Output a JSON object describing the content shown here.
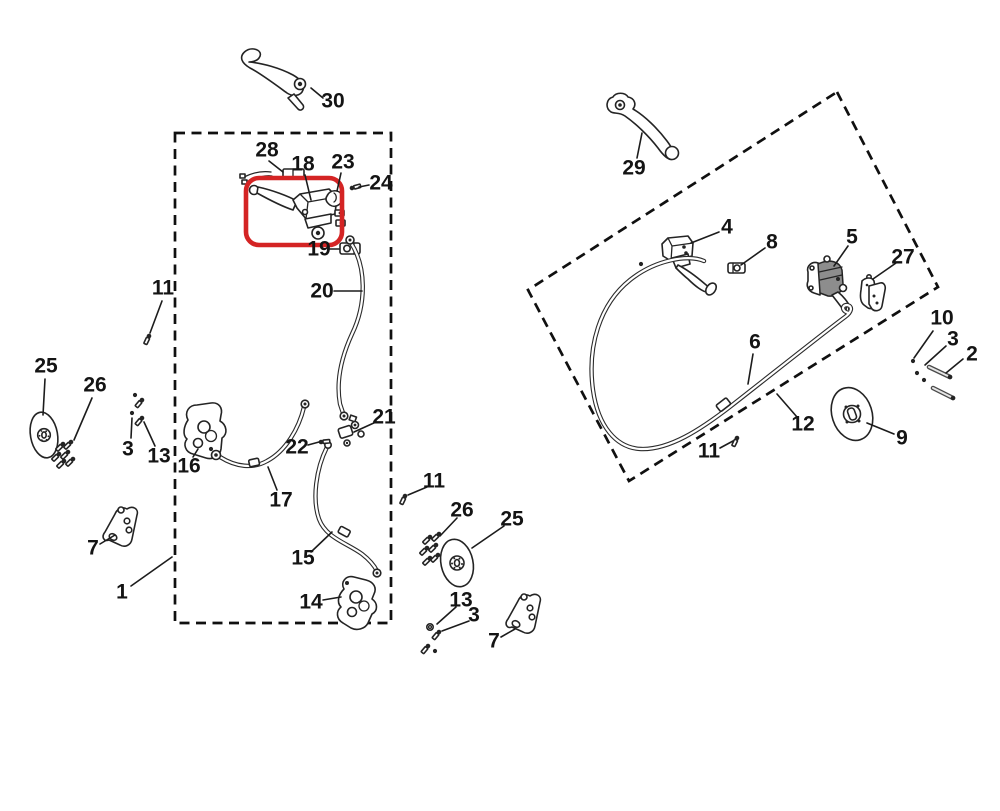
{
  "canvas": {
    "width": 1000,
    "height": 811,
    "background": "#ffffff"
  },
  "colors": {
    "line": "#242424",
    "highlight_red": "#d42424"
  },
  "highlight_box": {
    "x": 246,
    "y": 178,
    "width": 96,
    "height": 67,
    "rx": 13,
    "highlights_part": "18"
  },
  "group_boxes": {
    "front": {
      "type": "rect",
      "x": 175,
      "y": 133,
      "width": 216,
      "height": 490
    },
    "rear": {
      "type": "polygon",
      "points": "837,92 938,287 629,481 528,290"
    }
  },
  "callouts": [
    {
      "n": "30",
      "x": 333,
      "y": 101,
      "l": [
        311,
        88,
        323,
        98
      ]
    },
    {
      "n": "29",
      "x": 634,
      "y": 168,
      "l": [
        642,
        133,
        637,
        158
      ]
    },
    {
      "n": "28",
      "x": 267,
      "y": 150,
      "l": [
        269,
        161,
        283,
        172
      ]
    },
    {
      "n": "18",
      "x": 303,
      "y": 164,
      "l": [
        305,
        175,
        311,
        200
      ]
    },
    {
      "n": "23",
      "x": 343,
      "y": 162,
      "l": [
        341,
        173,
        337,
        191
      ]
    },
    {
      "n": "24",
      "x": 381,
      "y": 183,
      "l": [
        369,
        185,
        359,
        187
      ]
    },
    {
      "n": "19",
      "x": 319,
      "y": 249,
      "l": [
        330,
        249,
        339,
        249
      ]
    },
    {
      "n": "20",
      "x": 322,
      "y": 291,
      "l": [
        334,
        291,
        362,
        291
      ]
    },
    {
      "n": "11",
      "x": 163,
      "y": 288,
      "l": [
        162,
        301,
        150,
        333
      ]
    },
    {
      "n": "25",
      "x": 46,
      "y": 366,
      "l": [
        45,
        379,
        43,
        415
      ]
    },
    {
      "n": "26",
      "x": 95,
      "y": 385,
      "l": [
        92,
        398,
        74,
        440
      ]
    },
    {
      "n": "3",
      "x": 128,
      "y": 449,
      "l": [
        131,
        438,
        132,
        418
      ]
    },
    {
      "n": "13",
      "x": 159,
      "y": 456,
      "l": [
        155,
        446,
        144,
        422
      ]
    },
    {
      "n": "16",
      "x": 189,
      "y": 466,
      "l": [
        193,
        457,
        198,
        449
      ]
    },
    {
      "n": "17",
      "x": 281,
      "y": 500,
      "l": [
        277,
        490,
        268,
        467
      ]
    },
    {
      "n": "22",
      "x": 297,
      "y": 447,
      "l": [
        308,
        445,
        319,
        442
      ]
    },
    {
      "n": "21",
      "x": 384,
      "y": 417,
      "l": [
        376,
        422,
        354,
        432
      ]
    },
    {
      "n": "15",
      "x": 303,
      "y": 558,
      "l": [
        311,
        552,
        332,
        532
      ]
    },
    {
      "n": "14",
      "x": 311,
      "y": 602,
      "l": [
        323,
        600,
        341,
        597
      ]
    },
    {
      "n": "7",
      "x": 93,
      "y": 548,
      "l": [
        100,
        544,
        115,
        535
      ]
    },
    {
      "n": "1",
      "x": 122,
      "y": 592,
      "l": [
        131,
        586,
        172,
        557
      ]
    },
    {
      "n": "11",
      "x": 434,
      "y": 481,
      "l": [
        427,
        487,
        408,
        495
      ]
    },
    {
      "n": "26",
      "x": 462,
      "y": 510,
      "l": [
        457,
        518,
        440,
        536
      ]
    },
    {
      "n": "25",
      "x": 512,
      "y": 519,
      "l": [
        504,
        526,
        472,
        548
      ]
    },
    {
      "n": "13",
      "x": 461,
      "y": 600,
      "l": [
        456,
        607,
        437,
        624
      ]
    },
    {
      "n": "3",
      "x": 474,
      "y": 615,
      "l": [
        469,
        621,
        442,
        631
      ]
    },
    {
      "n": "7",
      "x": 494,
      "y": 641,
      "l": [
        501,
        637,
        515,
        629
      ]
    },
    {
      "n": "4",
      "x": 727,
      "y": 227,
      "l": [
        719,
        232,
        691,
        243
      ]
    },
    {
      "n": "8",
      "x": 772,
      "y": 242,
      "l": [
        765,
        248,
        741,
        265
      ]
    },
    {
      "n": "5",
      "x": 852,
      "y": 237,
      "l": [
        848,
        246,
        834,
        266
      ]
    },
    {
      "n": "27",
      "x": 903,
      "y": 257,
      "l": [
        896,
        263,
        873,
        279
      ]
    },
    {
      "n": "6",
      "x": 755,
      "y": 342,
      "l": [
        753,
        354,
        748,
        384
      ]
    },
    {
      "n": "12",
      "x": 803,
      "y": 424,
      "l": [
        797,
        417,
        777,
        394
      ]
    },
    {
      "n": "11",
      "x": 709,
      "y": 451,
      "l": [
        720,
        448,
        733,
        441
      ]
    },
    {
      "n": "10",
      "x": 942,
      "y": 318,
      "l": [
        933,
        331,
        914,
        358
      ]
    },
    {
      "n": "3",
      "x": 953,
      "y": 339,
      "l": [
        946,
        346,
        925,
        365
      ]
    },
    {
      "n": "2",
      "x": 972,
      "y": 354,
      "l": [
        963,
        359,
        946,
        373
      ]
    },
    {
      "n": "9",
      "x": 902,
      "y": 438,
      "l": [
        894,
        434,
        867,
        423
      ]
    }
  ],
  "hardware": {
    "bolts": [
      [
        352,
        188,
        -15
      ],
      [
        321,
        442,
        -5
      ],
      [
        149,
        336,
        115
      ],
      [
        142,
        400,
        130
      ],
      [
        142,
        418,
        130
      ],
      [
        63,
        444,
        135
      ],
      [
        71,
        442,
        135
      ],
      [
        59,
        454,
        135
      ],
      [
        68,
        452,
        135
      ],
      [
        64,
        461,
        135
      ],
      [
        73,
        459,
        135
      ],
      [
        405,
        496,
        115
      ],
      [
        430,
        537,
        135
      ],
      [
        439,
        534,
        135
      ],
      [
        427,
        548,
        135
      ],
      [
        436,
        545,
        135
      ],
      [
        430,
        558,
        135
      ],
      [
        438,
        555,
        135
      ],
      [
        439,
        632,
        130
      ],
      [
        428,
        646,
        130
      ],
      [
        737,
        438,
        115
      ]
    ],
    "washer_dots": [
      [
        135,
        395
      ],
      [
        132,
        413
      ],
      [
        211,
        449
      ],
      [
        435,
        651
      ],
      [
        641,
        264
      ],
      [
        913,
        361
      ],
      [
        917,
        373
      ],
      [
        924,
        380
      ]
    ],
    "washer_rings": [
      [
        430,
        627
      ]
    ],
    "pins": [
      [
        929,
        367,
        950,
        377
      ],
      [
        933,
        388,
        953,
        398
      ]
    ]
  },
  "parts_catalog": [
    {
      "ref": "30",
      "icon": "brake-lever-icon"
    },
    {
      "ref": "29",
      "icon": "brake-lever-icon"
    },
    {
      "ref": "18",
      "icon": "master-cylinder-icon",
      "highlighted": true
    },
    {
      "ref": "28",
      "icon": "handlebar-clamp-icon"
    },
    {
      "ref": "23",
      "icon": "pivot-ring-icon"
    },
    {
      "ref": "24",
      "icon": "bolt-icon"
    },
    {
      "ref": "19",
      "icon": "hose-clamp-icon"
    },
    {
      "ref": "20",
      "icon": "brake-hose-icon"
    },
    {
      "ref": "21",
      "icon": "tee-union-icon"
    },
    {
      "ref": "22",
      "icon": "bolt-icon"
    },
    {
      "ref": "17",
      "icon": "brake-hose-icon"
    },
    {
      "ref": "16",
      "icon": "brake-caliper-icon"
    },
    {
      "ref": "15",
      "icon": "brake-hose-icon"
    },
    {
      "ref": "14",
      "icon": "brake-caliper-icon"
    },
    {
      "ref": "25",
      "icon": "brake-disc-icon"
    },
    {
      "ref": "26",
      "icon": "bolt-set-icon"
    },
    {
      "ref": "13",
      "icon": "washer-icon"
    },
    {
      "ref": "11",
      "icon": "bolt-icon"
    },
    {
      "ref": "3",
      "icon": "bolt-icon"
    },
    {
      "ref": "7",
      "icon": "mounting-bracket-icon"
    },
    {
      "ref": "1",
      "icon": "front-brake-group-box"
    },
    {
      "ref": "4",
      "icon": "master-cylinder-icon"
    },
    {
      "ref": "8",
      "icon": "clamp-icon"
    },
    {
      "ref": "5",
      "icon": "master-cylinder-icon"
    },
    {
      "ref": "27",
      "icon": "brake-pads-icon"
    },
    {
      "ref": "6",
      "icon": "brake-hose-icon"
    },
    {
      "ref": "12",
      "icon": "rear-brake-group-box"
    },
    {
      "ref": "10",
      "icon": "washer-icon"
    },
    {
      "ref": "2",
      "icon": "pin-icon"
    },
    {
      "ref": "9",
      "icon": "brake-disc-icon"
    }
  ]
}
